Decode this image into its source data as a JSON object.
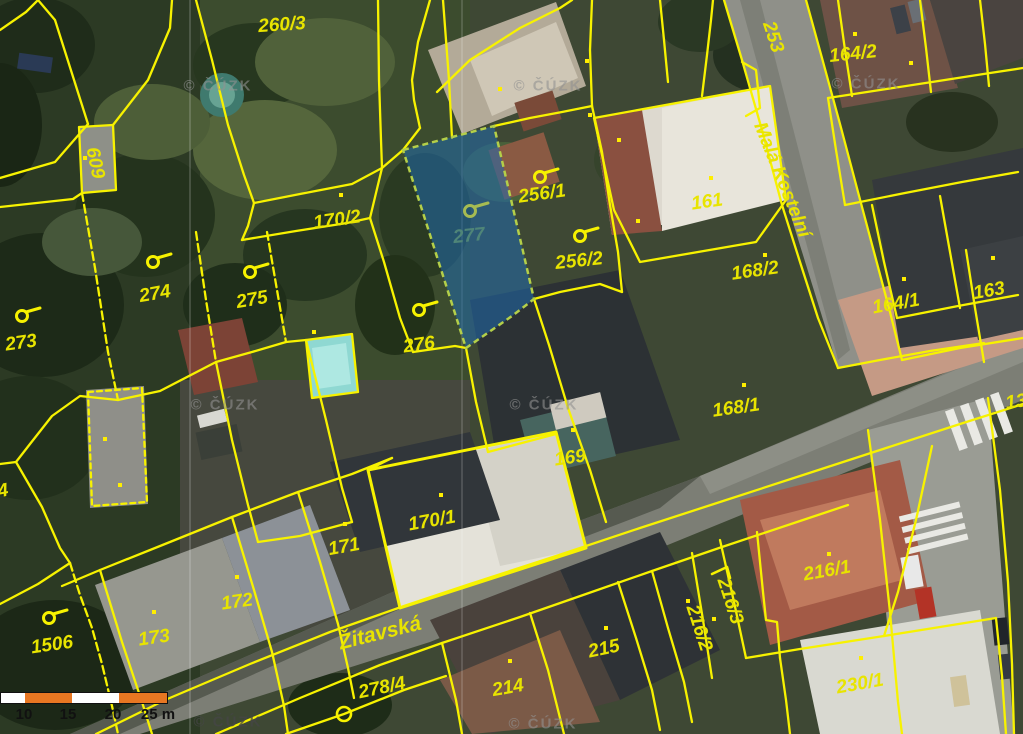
{
  "app": {
    "title": "Cadastral map with orthophoto"
  },
  "map": {
    "selected_parcel_number": "277",
    "watermark_text": "© ČÚZK",
    "parcel_labels": [
      {
        "text": "260/3"
      },
      {
        "text": "253"
      },
      {
        "text": "164/2"
      },
      {
        "text": "609"
      },
      {
        "text": "170/2"
      },
      {
        "text": "256/1"
      },
      {
        "text": "277"
      },
      {
        "text": "256/2"
      },
      {
        "text": "161"
      },
      {
        "text": "168/2"
      },
      {
        "text": "274"
      },
      {
        "text": "275"
      },
      {
        "text": "273"
      },
      {
        "text": "276"
      },
      {
        "text": "164/1"
      },
      {
        "text": "163"
      },
      {
        "text": "168/1"
      },
      {
        "text": "169"
      },
      {
        "text": "170/1"
      },
      {
        "text": "171"
      },
      {
        "text": "172"
      },
      {
        "text": "173"
      },
      {
        "text": "1506"
      },
      {
        "text": "215"
      },
      {
        "text": "214"
      },
      {
        "text": "278/4"
      },
      {
        "text": "216/1"
      },
      {
        "text": "216/2"
      },
      {
        "text": "216/3"
      },
      {
        "text": "230/1"
      },
      {
        "text": "13"
      },
      {
        "text": "4"
      }
    ],
    "street_names": [
      {
        "text": "Žitavská"
      },
      {
        "text": "Malá Kostelní"
      }
    ],
    "scale_bar": {
      "tick_labels": [
        "10",
        "15",
        "20",
        "25 m"
      ]
    },
    "colors": {
      "boundary_yellow": "#f7f200",
      "selection_fill": "#1f69ad",
      "selection_outline": "#b4cf49",
      "selected_label": "#4f8578",
      "pool_cyan": "#8fd8d2",
      "scalebar_orange": "#e87722"
    }
  }
}
